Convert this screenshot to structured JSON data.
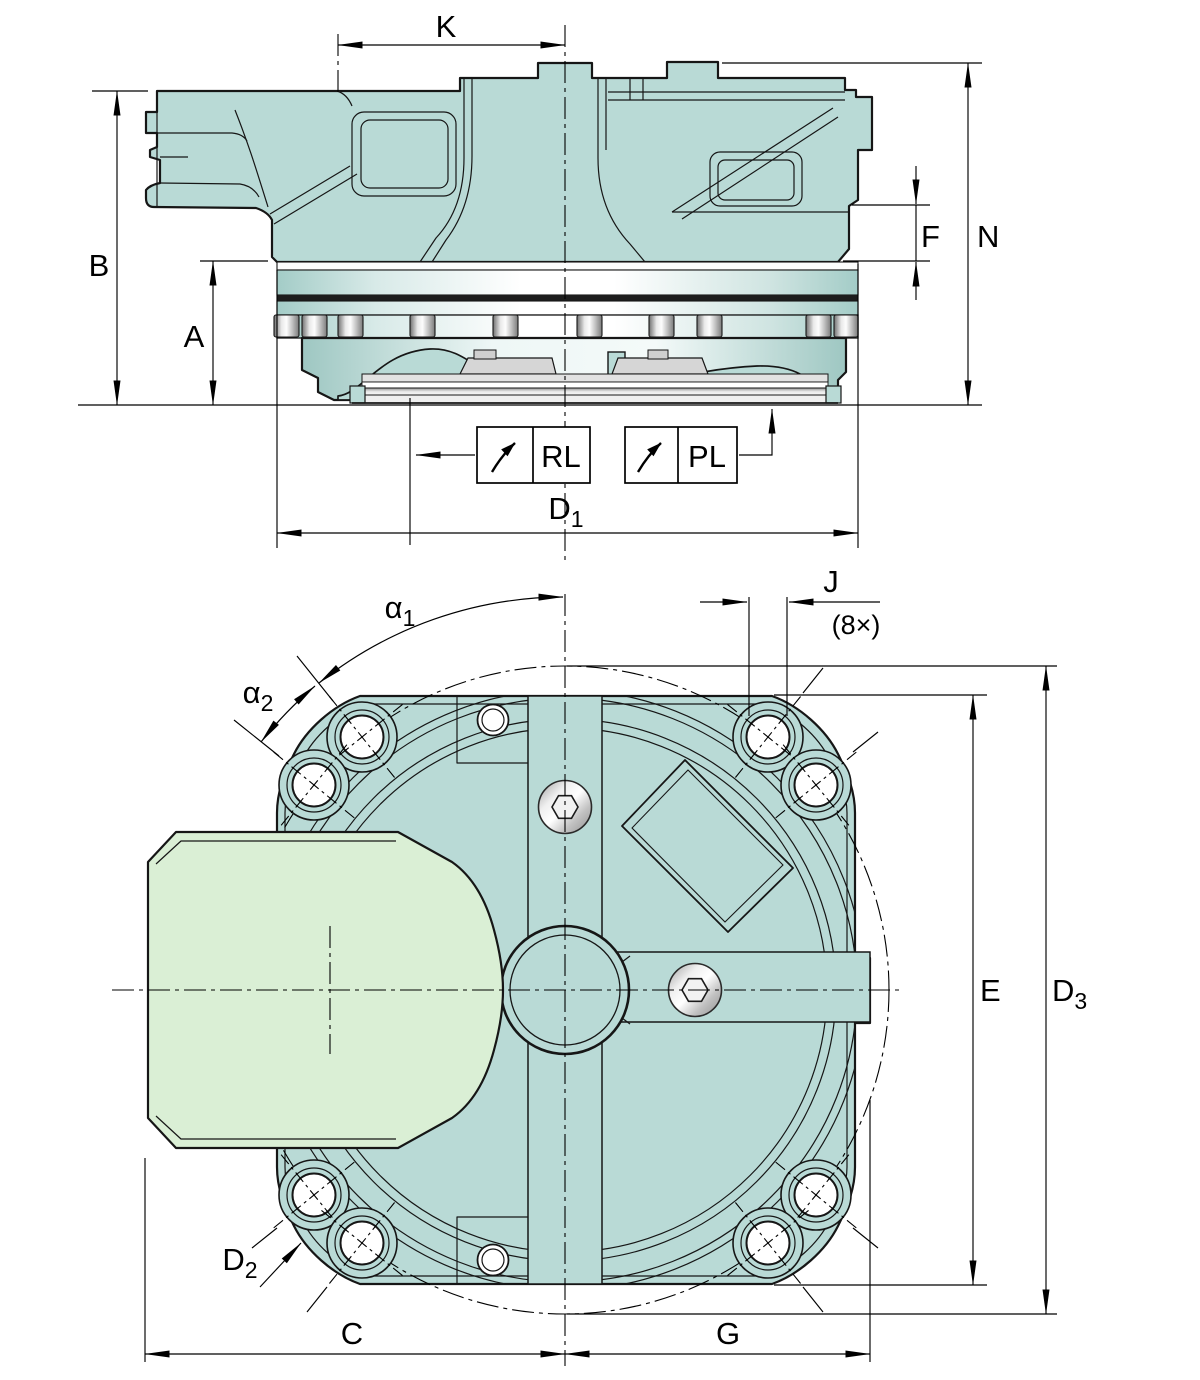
{
  "drawing": {
    "colors": {
      "housing_teal": "#b9dad6",
      "clamp_green": "#daefd5",
      "outline": "#161616",
      "metal_light": "#f5f5f5",
      "metal_dark": "#6f6f6f",
      "background": "#ffffff"
    },
    "top_view": {
      "labels": {
        "K": "K",
        "B": "B",
        "A": "A",
        "F": "F",
        "N": "N",
        "D1": {
          "base": "D",
          "sub": "1"
        },
        "RL": "RL",
        "PL": "PL"
      }
    },
    "bottom_view": {
      "labels": {
        "alpha1": {
          "base": "α",
          "sub": "1"
        },
        "alpha2": {
          "base": "α",
          "sub": "2"
        },
        "J": "J",
        "J_count": "(8×)",
        "E": "E",
        "D2": {
          "base": "D",
          "sub": "2"
        },
        "D3": {
          "base": "D",
          "sub": "3"
        },
        "C": "C",
        "G": "G"
      }
    }
  }
}
